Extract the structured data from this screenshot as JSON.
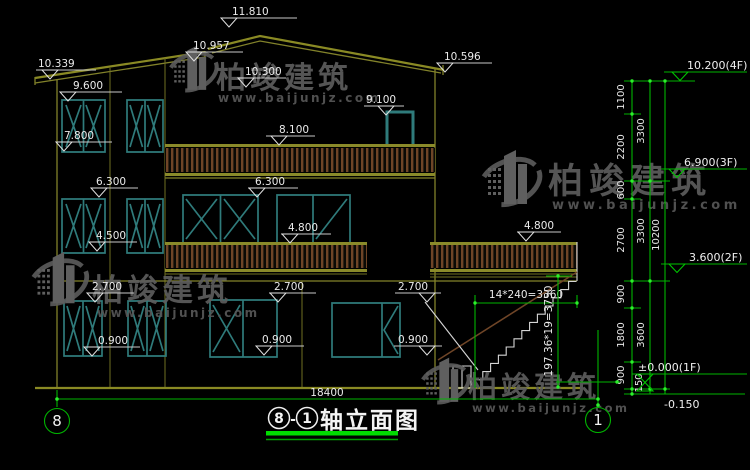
{
  "marks": {
    "e10339": "10.339",
    "e11810": "11.810",
    "e10957": "10.957",
    "e10300": "10.300",
    "e10596": "10.596",
    "e9600": "9.600",
    "e7800": "7.800",
    "e9100": "9.100",
    "e8100": "8.100",
    "e6300": "6.300",
    "e4500": "4.500",
    "e4800": "4.800",
    "e2700": "2.700",
    "e0900": "0.900"
  },
  "chain": {
    "f4": "10.200(4F)",
    "f3": "6.900(3F)",
    "f2": "3.600(2F)",
    "f1": "±0.000(1F)",
    "base": "-0.150",
    "d1100": "1100",
    "d2200": "2200",
    "d600": "600",
    "d2700": "2700",
    "d900": "900",
    "d1800": "1800",
    "d150": "150",
    "d3300": "3300",
    "d3600": "3600",
    "d10200": "10200"
  },
  "stairs": {
    "run": "14*240=3360",
    "rise": "197.36*19=3750"
  },
  "bottom": {
    "overall": "18400",
    "axis8": "8",
    "axis1": "1"
  },
  "title": {
    "a8": "8",
    "dash": "-",
    "a1": "1",
    "label": "轴立面图"
  },
  "watermark": {
    "brand": "柏竣建筑",
    "url": "www.baijunjz.com"
  }
}
